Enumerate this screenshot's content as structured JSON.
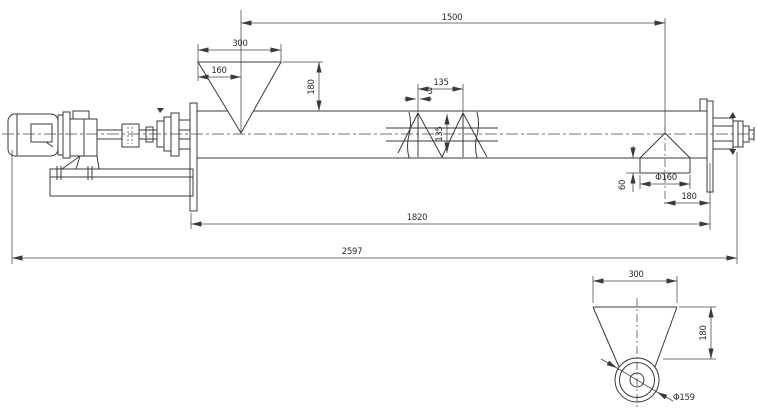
{
  "colors": {
    "background": "#ffffff",
    "line": "#3a3a3a"
  },
  "main_view": {
    "dims": {
      "top_overall": "1500",
      "hopper_width": "300",
      "hopper_offset": "160",
      "hopper_height": "180",
      "screw_pitch": "135",
      "flight_thickness": "3",
      "screw_diameter": "135",
      "spout_drop": "60",
      "spout_diameter": "Φ160",
      "spout_to_end": "180",
      "trough_length": "1820",
      "overall_length": "2597"
    }
  },
  "detail_view": {
    "dims": {
      "width": "300",
      "height": "180",
      "pipe_diameter": "Φ159"
    }
  }
}
